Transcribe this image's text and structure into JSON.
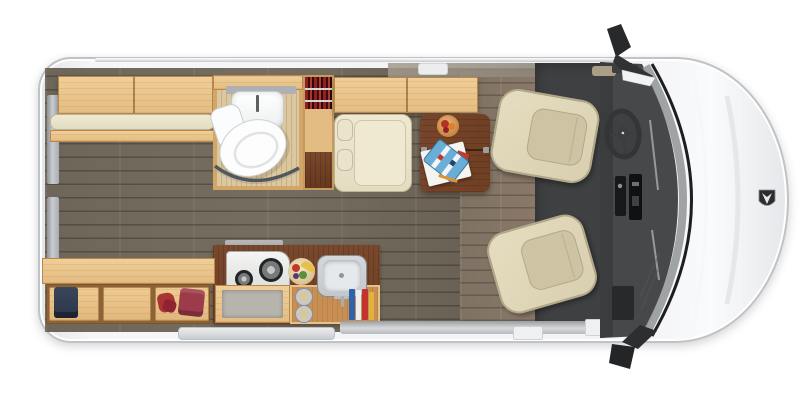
{
  "meta": {
    "description": "Top-down floor plan of a Class B camper van (Sprinter-style), front of vehicle at right",
    "orientation": "front-right, rear-left"
  },
  "palette": {
    "bodyEdge": "#bfc2c6",
    "floorDark": "#6e6659",
    "floorBrown": "#8a7868",
    "cabMat": "#3e4042",
    "woodLight": "#e4bd83",
    "woodBorder": "#b8864e",
    "woodDark": "#6f3f23",
    "cushion": "#e2dcc1",
    "seat": "#d8cfb0",
    "seatInner": "#cec4a4",
    "seatEdge": "#b2a88a",
    "dash": "#46484a",
    "glass": "#9b9ea1",
    "trim": "#1d1e1f",
    "steel": "#c3c8cc",
    "redTextile": "#8f2125",
    "navy": "#2c3648",
    "bathFloor": "#dcc8a0",
    "bathFloorLine": "#c8b083"
  },
  "labels": {
    "van_body": "van body shell",
    "rear_doors": "rear door windows",
    "rear_overhead_cabinet": "rear overhead cabinet",
    "rear_sofa": "rear sofa cushion",
    "bathroom": "wet bath with sink, toilet and shower curtain",
    "toilet": "toilet",
    "bath_sink": "bathroom sink",
    "wardrobe": "wardrobe with hanging red clothes",
    "dinette_cabinet": "overhead cabinet above dinette",
    "dinette_bench": "forward-facing dinette bench with headrests",
    "dinette_table": "dinette table with fruit bowl, game box, papers and pencil",
    "galley": "galley with two-burner stove, fruit bowl and stainless sink",
    "stove": "two-burner stove",
    "galley_sink": "stainless galley sink",
    "oven": "oven / storage under stove",
    "storage_row": "under-sofa storage with duffel bag, gloves and blanket",
    "cab_mat": "cab floor",
    "dashboard": "dashboard and windshield",
    "steering_wheel": "steering wheel",
    "driver_seat": "driver swivel seat",
    "passenger_seat": "passenger swivel seat",
    "mirror_top": "driver side mirror",
    "mirror_bottom": "passenger side mirror",
    "hood_badge": "hood badge",
    "sliding_door_rail": "sliding door rail",
    "running_board": "running board step"
  },
  "objects": {
    "storage_items": [
      "navy duffel bag",
      "empty compartment",
      "red gloves",
      "red folded blanket"
    ],
    "table_items": [
      "fruit bowl",
      "blue game box",
      "white papers",
      "pencil"
    ],
    "galley_items": [
      "two-burner stove",
      "fruit bowl with banana",
      "stainless sink with faucet",
      "two canisters",
      "condiment bottles"
    ],
    "bath_items": [
      "corner sink with faucet",
      "toilet",
      "shower curtain"
    ],
    "wardrobe_items": [
      "red clothing on two hanger rods"
    ],
    "cab_items": [
      "driver swivel seat",
      "passenger swivel seat",
      "steering wheel",
      "center console stack",
      "windshield",
      "two exterior mirrors",
      "hood badge"
    ]
  }
}
